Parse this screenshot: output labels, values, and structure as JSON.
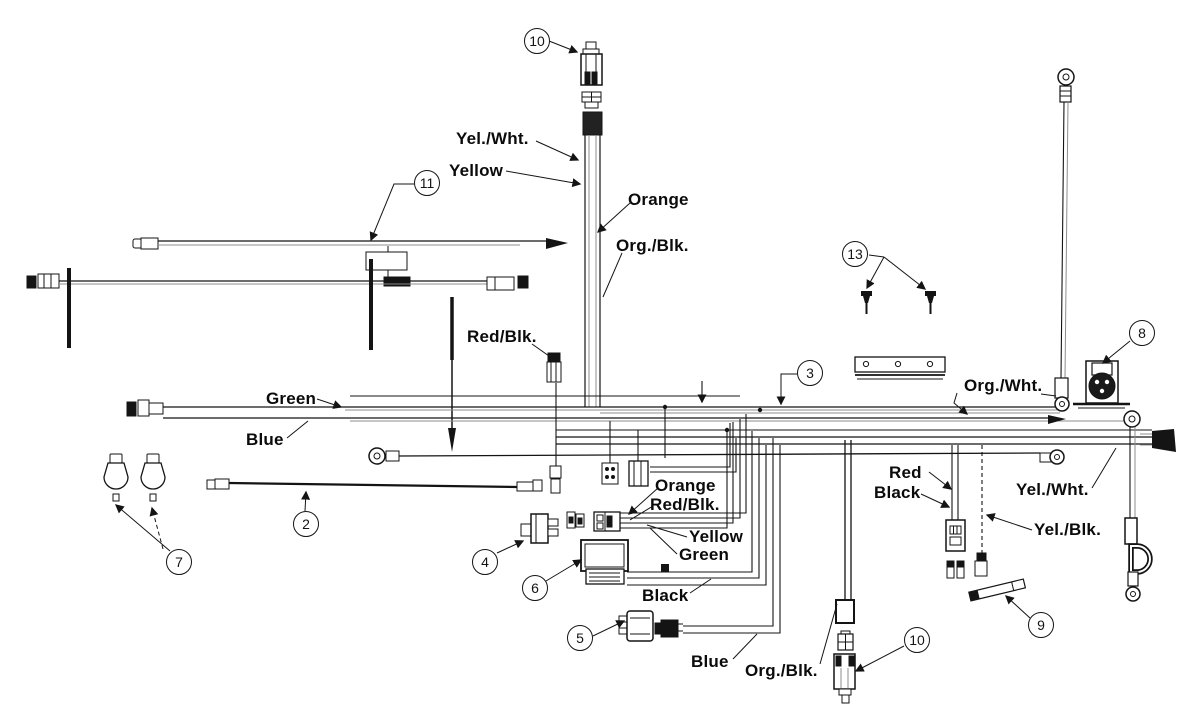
{
  "diagram": {
    "callouts": {
      "c10_top": "10",
      "c11": "11",
      "c13": "13",
      "c3": "3",
      "c8": "8",
      "c2": "2",
      "c7": "7",
      "c4": "4",
      "c6": "6",
      "c5": "5",
      "c9": "9",
      "c10_bottom": "10"
    },
    "wire_labels": {
      "yel_wht_top": "Yel./Wht.",
      "yellow_top": "Yellow",
      "orange_top": "Orange",
      "org_blk_top": "Org./Blk.",
      "red_blk_top": "Red/Blk.",
      "green_left": "Green",
      "blue_left": "Blue",
      "org_wht": "Org./Wht.",
      "red_right": "Red",
      "black_right": "Black",
      "yel_wht_right": "Yel./Wht.",
      "yel_blk_right": "Yel./Blk.",
      "orange_mid": "Orange",
      "red_blk_mid": "Red/Blk.",
      "yellow_mid": "Yellow",
      "green_mid": "Green",
      "black_mid": "Black",
      "blue_bottom": "Blue",
      "org_blk_bottom": "Org./Blk."
    },
    "line_color": "#141414",
    "faint_color": "#8d8d8d"
  }
}
